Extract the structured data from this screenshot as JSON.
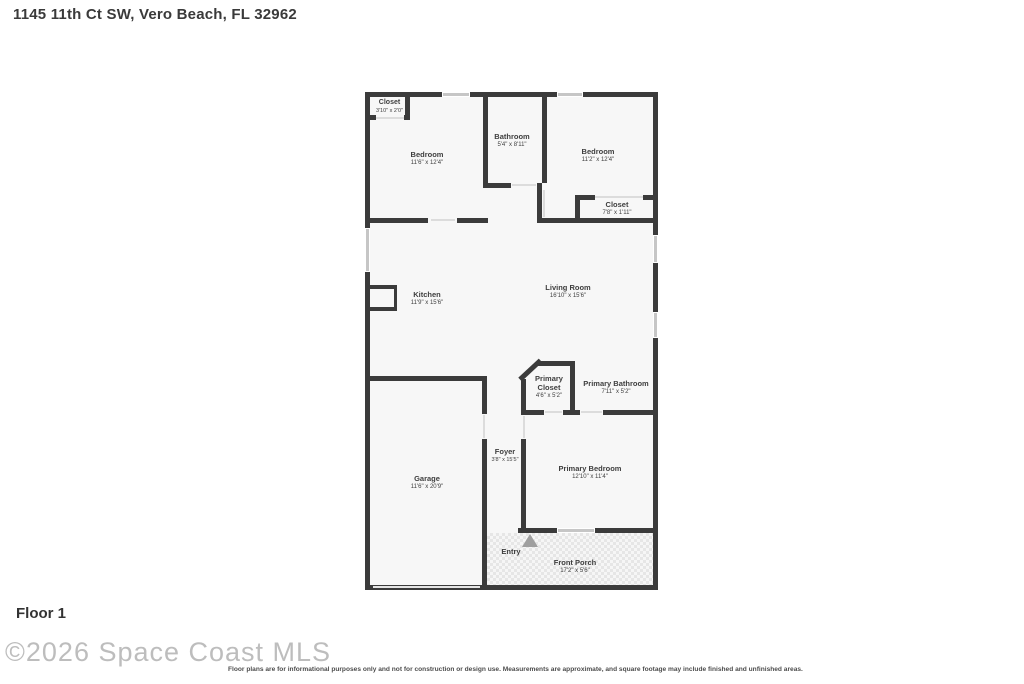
{
  "header": {
    "address": "1145 11th Ct SW, Vero Beach, FL 32962"
  },
  "footer": {
    "floor_label": "Floor 1",
    "watermark": "©2026 Space Coast MLS",
    "disclaimer": "Floor plans are for informational purposes only and not for construction or design use. Measurements are approximate, and square footage may include finished and unfinished areas."
  },
  "rooms": [
    {
      "name": "Closet",
      "dims": "3'10\" x 2'0\""
    },
    {
      "name": "Bedroom",
      "dims": "11'6\" x 12'4\""
    },
    {
      "name": "Bathroom",
      "dims": "5'4\" x 8'11\""
    },
    {
      "name": "Bedroom",
      "dims": "11'2\" x 12'4\""
    },
    {
      "name": "Closet",
      "dims": "7'8\" x 1'11\""
    },
    {
      "name": "Kitchen",
      "dims": "11'9\" x 15'6\""
    },
    {
      "name": "Living Room",
      "dims": "16'10\" x 15'6\""
    },
    {
      "name": "Primary Closet",
      "dims": "4'6\" x 5'2\""
    },
    {
      "name": "Primary Bathroom",
      "dims": "7'11\" x 5'2\""
    },
    {
      "name": "Foyer",
      "dims": "3'8\" x 15'5\""
    },
    {
      "name": "Garage",
      "dims": "11'6\" x 20'9\""
    },
    {
      "name": "Primary Bedroom",
      "dims": "12'10\" x 11'4\""
    },
    {
      "name": "Entry",
      "dims": ""
    },
    {
      "name": "Front Porch",
      "dims": "17'2\" x 5'6\""
    }
  ],
  "colors": {
    "wall": "#3b3b3b",
    "floor": "#f7f7f7",
    "window": "#c6c6c6",
    "text": "#3e3e3e"
  }
}
